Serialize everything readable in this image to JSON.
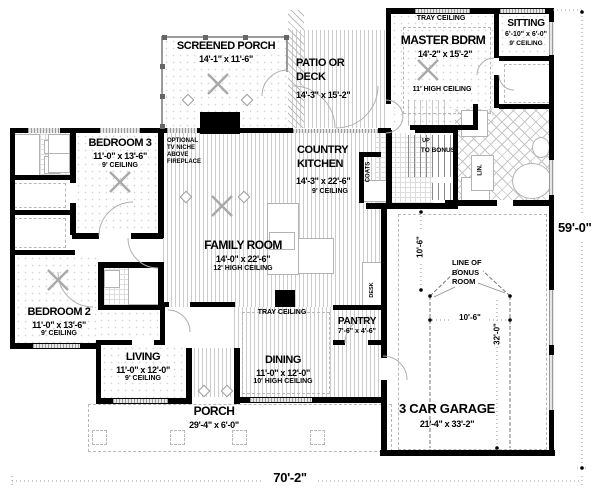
{
  "rooms": {
    "screened_porch": {
      "name": "SCREENED PORCH",
      "dims": "14'-1\" x 11'-6\""
    },
    "patio": {
      "name": "PATIO OR\nDECK",
      "dims": "14'-3\" x 15'-2\""
    },
    "master": {
      "tray": "TRAY CEILING",
      "name": "MASTER BDRM",
      "dims": "14'-2\" x 15'-2\"",
      "ceiling": "11' HIGH CEILING"
    },
    "sitting": {
      "name": "SITTING",
      "dims": "6'-10\" x 6'-0\"",
      "ceiling": "9' CEILING"
    },
    "bedroom3": {
      "name": "BEDROOM 3",
      "dims": "11'-0\" x 13'-6\"",
      "ceiling": "9' CEILING"
    },
    "country_kitchen": {
      "name": "COUNTRY\nKITCHEN",
      "dims": "14'-3\" x 22'-6\"",
      "ceiling": "9' CEILING"
    },
    "family_room": {
      "name": "FAMILY ROOM",
      "dims": "14'-0\" x 22'-6\"",
      "ceiling": "12' HIGH CEILING"
    },
    "bedroom2": {
      "name": "BEDROOM 2",
      "dims": "11'-0\" x 13'-6\"",
      "ceiling": "9' CEILING"
    },
    "living": {
      "name": "LIVING",
      "dims": "11'-0\" x 12'-0\"",
      "ceiling": "9' CEILING"
    },
    "dining": {
      "name": "DINING",
      "dims": "11'-0\" x 12'-0\"",
      "ceiling": "10' HIGH CEILING",
      "tray": "TRAY CEILING"
    },
    "pantry": {
      "name": "PANTRY",
      "dims": "7'-6\" x 4'-6\""
    },
    "porch": {
      "name": "PORCH",
      "dims": "29'-4\" x 6'-0\""
    },
    "garage": {
      "name": "3 CAR GARAGE",
      "dims": "21'-4\" x 33'-2\""
    }
  },
  "annotations": {
    "optional_tv": "OPTIONAL\nTV NICHE\nABOVE\nFIREPLACE",
    "up": "UP",
    "to_bonus": "TO BONUS",
    "coats": "COATS",
    "linen": "LIN.",
    "desk": "DESK",
    "line_of_bonus": "LINE OF\nBONUS\nROOM"
  },
  "dimensions": {
    "overall_width": "70'-2\"",
    "overall_depth": "59'-0\"",
    "bonus_width": "10'-6\"",
    "garage_depth": "32'-0\"",
    "bonus_offset": "10'-6\""
  },
  "colors": {
    "wall": "#000000",
    "hatch": "#c8c8c8",
    "dim_line": "#9a9a9a"
  }
}
